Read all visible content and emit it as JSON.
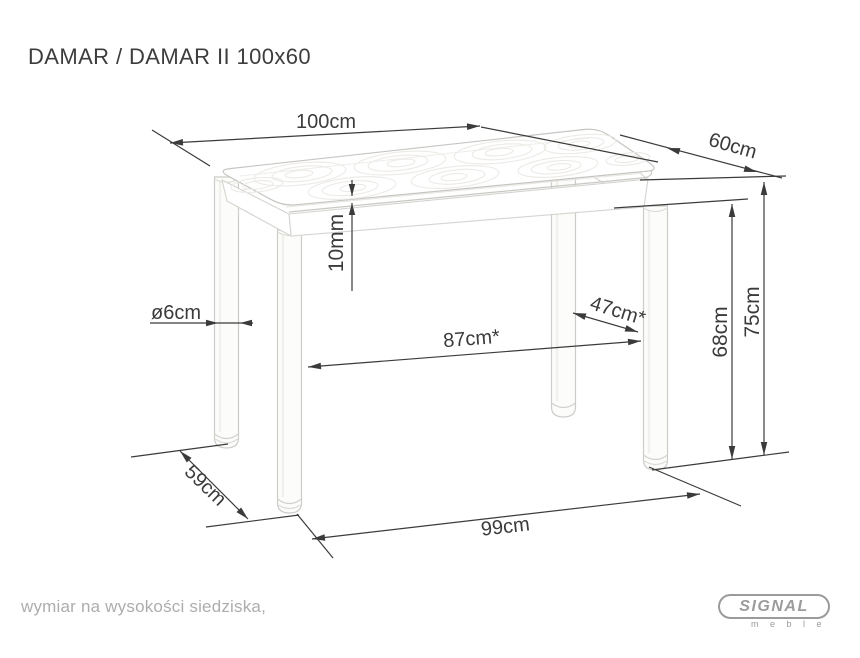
{
  "title": "DAMAR / DAMAR II 100x60",
  "dims": {
    "d100": "100cm",
    "d60": "60cm",
    "d10": "10mm",
    "dleg": "ø6cm",
    "d87": "87cm*",
    "d47": "47cm*",
    "d68": "68cm",
    "d75": "75cm",
    "d59": "59cm",
    "d99": "99cm"
  },
  "footnote": "wymiar na wysokości siedziska,",
  "logo": {
    "brand": "SIGNAL",
    "subtitle": "m e b l e"
  },
  "colors": {
    "dimension_lines": "#3b3b3b",
    "table_outline": "#c9c8c4",
    "table_detail": "#e7e6e2",
    "footnote_text": "#adadad",
    "logo_gray": "#9b9b9b",
    "background": "#ffffff"
  }
}
